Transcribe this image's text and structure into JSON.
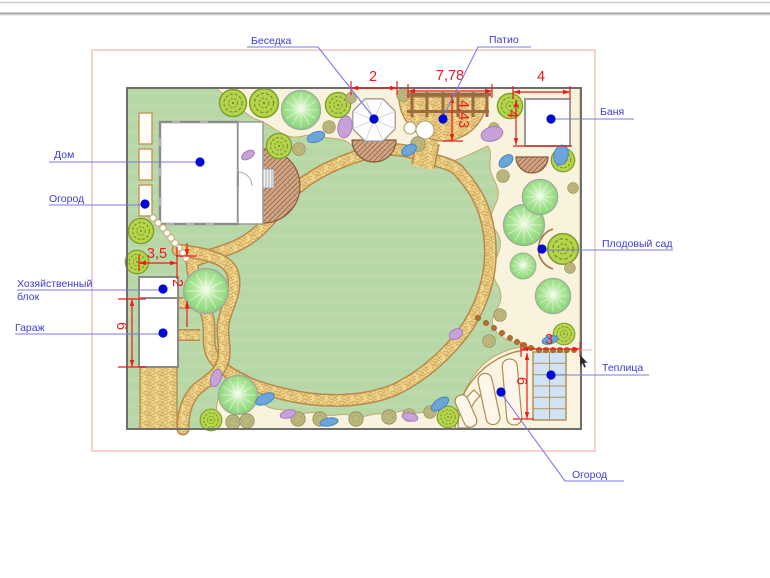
{
  "labels": {
    "besedka": "Беседка",
    "patio": "Патио",
    "banya": "Баня",
    "dom": "Дом",
    "ogorod_top": "Огород",
    "hozblok_line1": "Хозяйственный",
    "hozblok_line2": "блок",
    "garazh": "Гараж",
    "plodovy_sad": "Плодовый сад",
    "teplitsa": "Теплица",
    "ogorod_bottom": "Огород"
  },
  "dimensions": {
    "gazebo_width": "2",
    "patio_width": "7,78",
    "banya_width": "4",
    "patio_depth": "4,43",
    "banya_depth": "4",
    "hozblok_offset": "3,5",
    "hozblok_gap": "2",
    "garage_length": "6",
    "greenhouse_offset": "3",
    "garden_length": "6"
  },
  "icons": {
    "tree-icon": "deciduous tree symbol",
    "ornamental-shrub-icon": "patterned ornamental shrub symbol",
    "small-shrub-icon": "small olive shrub symbol",
    "flower-accent-icon": "blue/purple flower accent",
    "gazebo-icon": "octagonal gazebo",
    "stepping-stone-icon": "stepping stone dot",
    "leader-dot-icon": "blue reference point marker",
    "mouse-cursor-icon": "pointer cursor"
  },
  "colors": {
    "label_blue": "#3c3cd6",
    "dimension_red": "#ee1b1b",
    "marker_blue": "#0008d2",
    "lawn_green": "#b7d7a6",
    "bed_cream": "#f9f2dc",
    "path_sand": "#f1d78d",
    "greenhouse_blue": "#cfe3f5",
    "boundary_pink": "#f5b8b0"
  }
}
